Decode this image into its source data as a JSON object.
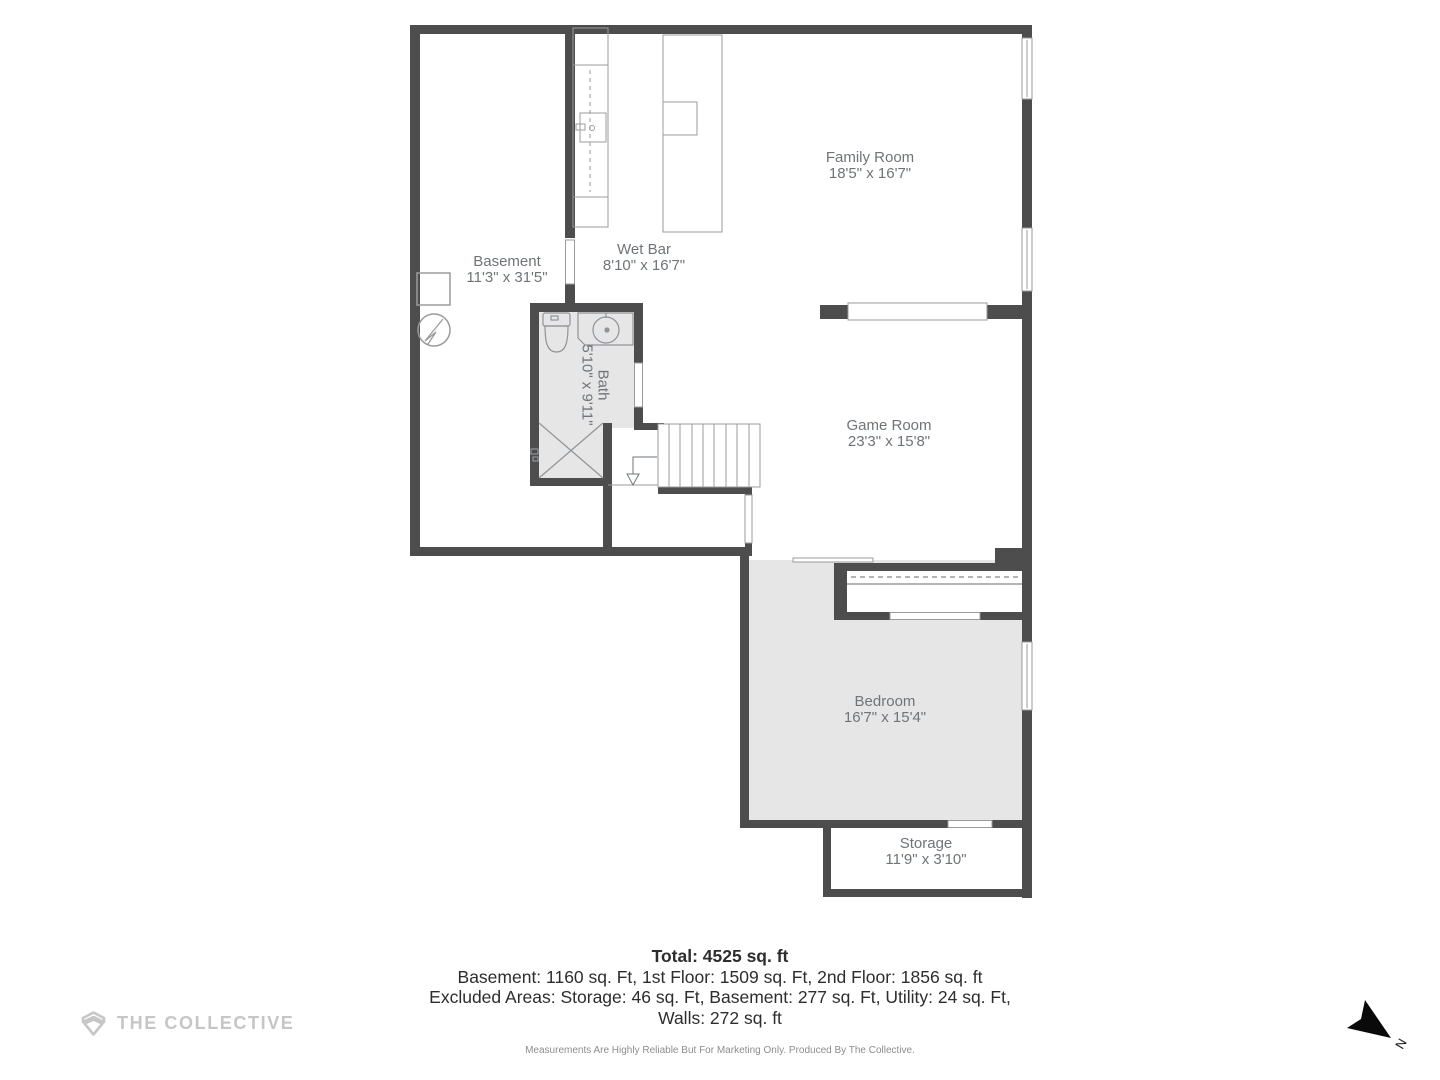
{
  "plan": {
    "rooms": {
      "basement": {
        "name": "Basement",
        "dims": "11'3\" x 31'5\""
      },
      "wet_bar": {
        "name": "Wet Bar",
        "dims": "8'10\" x 16'7\""
      },
      "family_room": {
        "name": "Family Room",
        "dims": "18'5\" x 16'7\""
      },
      "game_room": {
        "name": "Game Room",
        "dims": "23'3\" x 15'8\""
      },
      "bath": {
        "name": "Bath",
        "dims": "5'10\" x 9'11\""
      },
      "bedroom": {
        "name": "Bedroom",
        "dims": "16'7\" x 15'4\""
      },
      "storage": {
        "name": "Storage",
        "dims": "11'9\" x 3'10\""
      }
    },
    "colors": {
      "wall": "#4d4d4d",
      "room_fill": "#e6e6e6",
      "thin_line": "#9b9b9b",
      "label": "#6e747a"
    }
  },
  "summary": {
    "total": "Total: 4525 sq. ft",
    "floors": "Basement: 1160 sq. Ft, 1st Floor: 1509 sq. Ft, 2nd Floor: 1856 sq. ft",
    "excluded": "Excluded Areas: Storage: 46 sq. Ft, Basement: 277 sq. Ft, Utility: 24 sq. Ft,",
    "walls": "Walls: 272 sq. ft"
  },
  "branding": {
    "logo_text": "THE COLLECTIVE"
  },
  "disclaimer": "Measurements Are Highly Reliable But For Marketing Only. Produced By The Collective.",
  "compass": {
    "label": "N"
  }
}
